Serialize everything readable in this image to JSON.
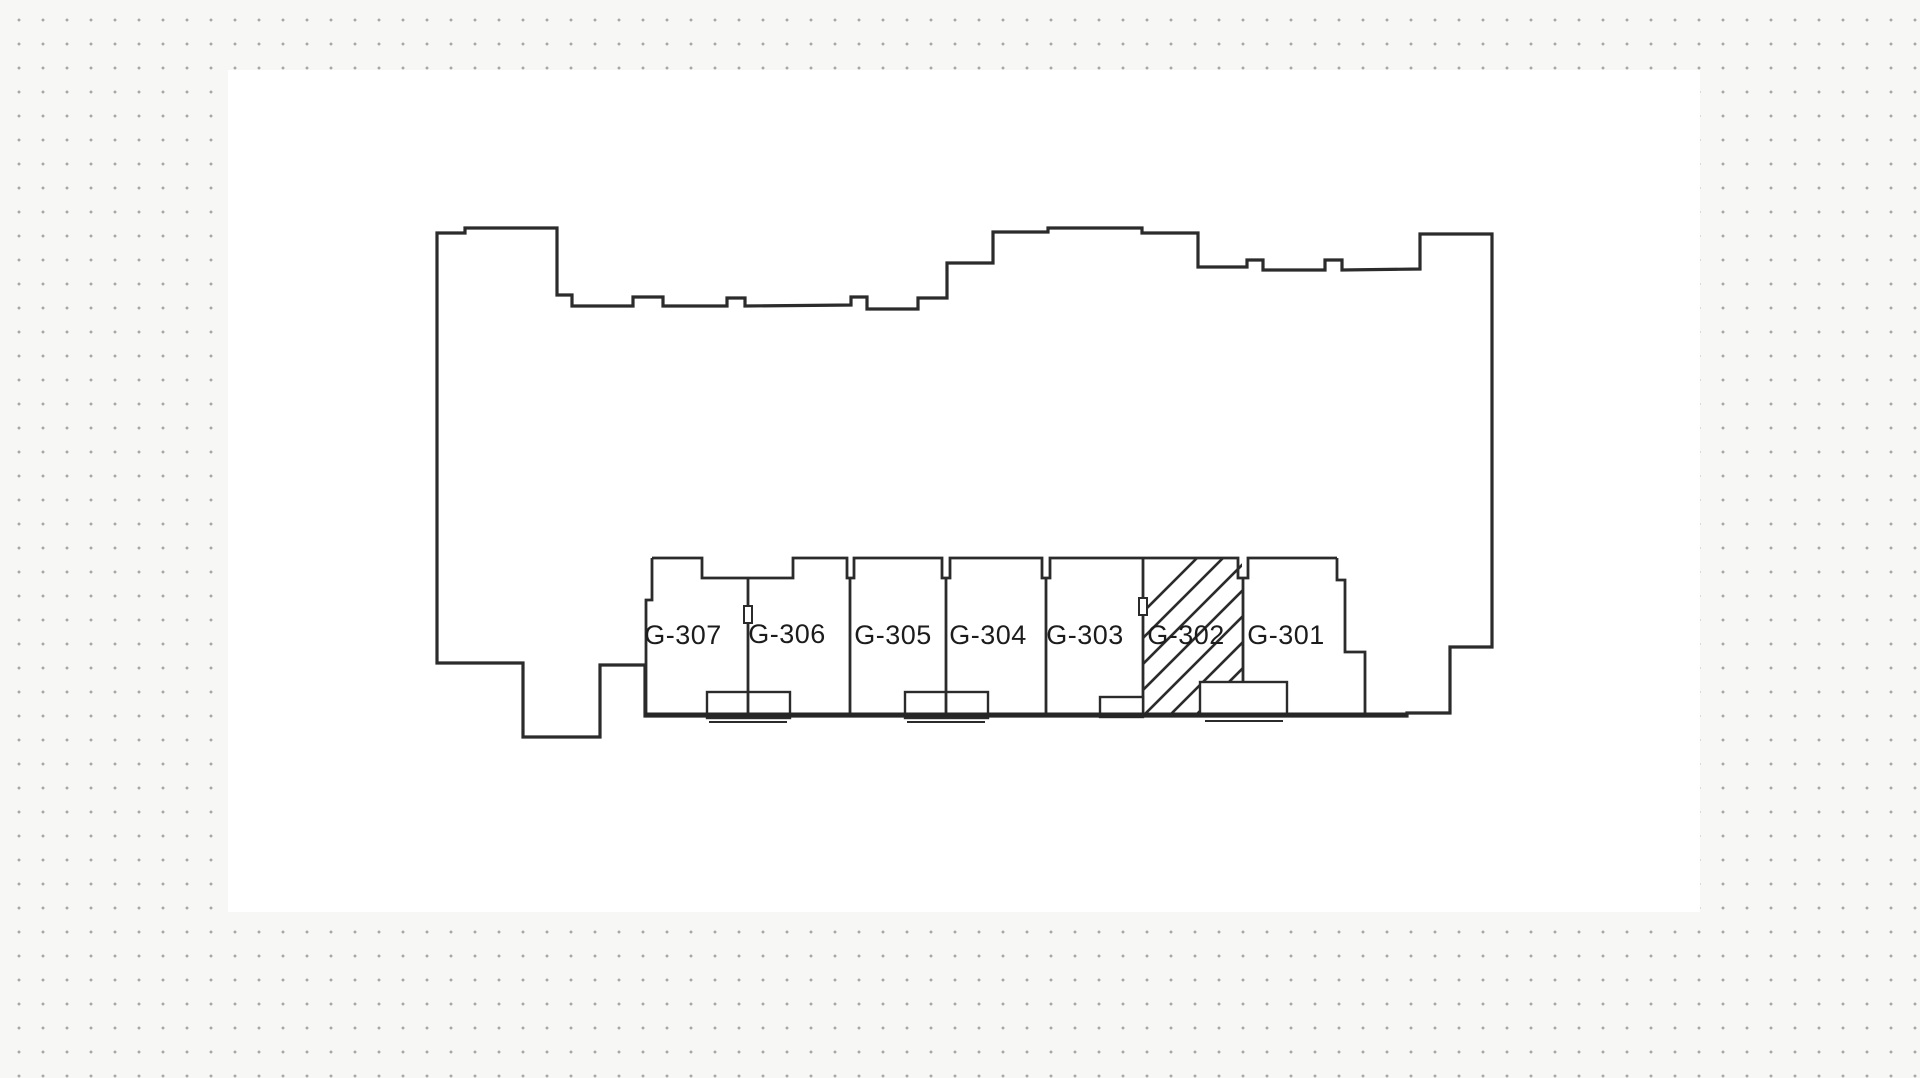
{
  "colors": {
    "paper": "#f7f7f5",
    "plan_area": "#ffffff",
    "background_dots": "#a8a8a8",
    "drawing_line": "#2b2b2b",
    "label_text": "#1c1c1c"
  },
  "floorplan": {
    "type": "scanned-building-floor-plan",
    "rooms": [
      {
        "label": "G-307",
        "highlighted": false
      },
      {
        "label": "G-306",
        "highlighted": false
      },
      {
        "label": "G-305",
        "highlighted": false
      },
      {
        "label": "G-304",
        "highlighted": false
      },
      {
        "label": "G-303",
        "highlighted": false
      },
      {
        "label": "G-302",
        "highlighted": true
      },
      {
        "label": "G-301",
        "highlighted": false
      }
    ],
    "highlighted_room": "G-302",
    "highlight_style": "diagonal-hatch"
  }
}
